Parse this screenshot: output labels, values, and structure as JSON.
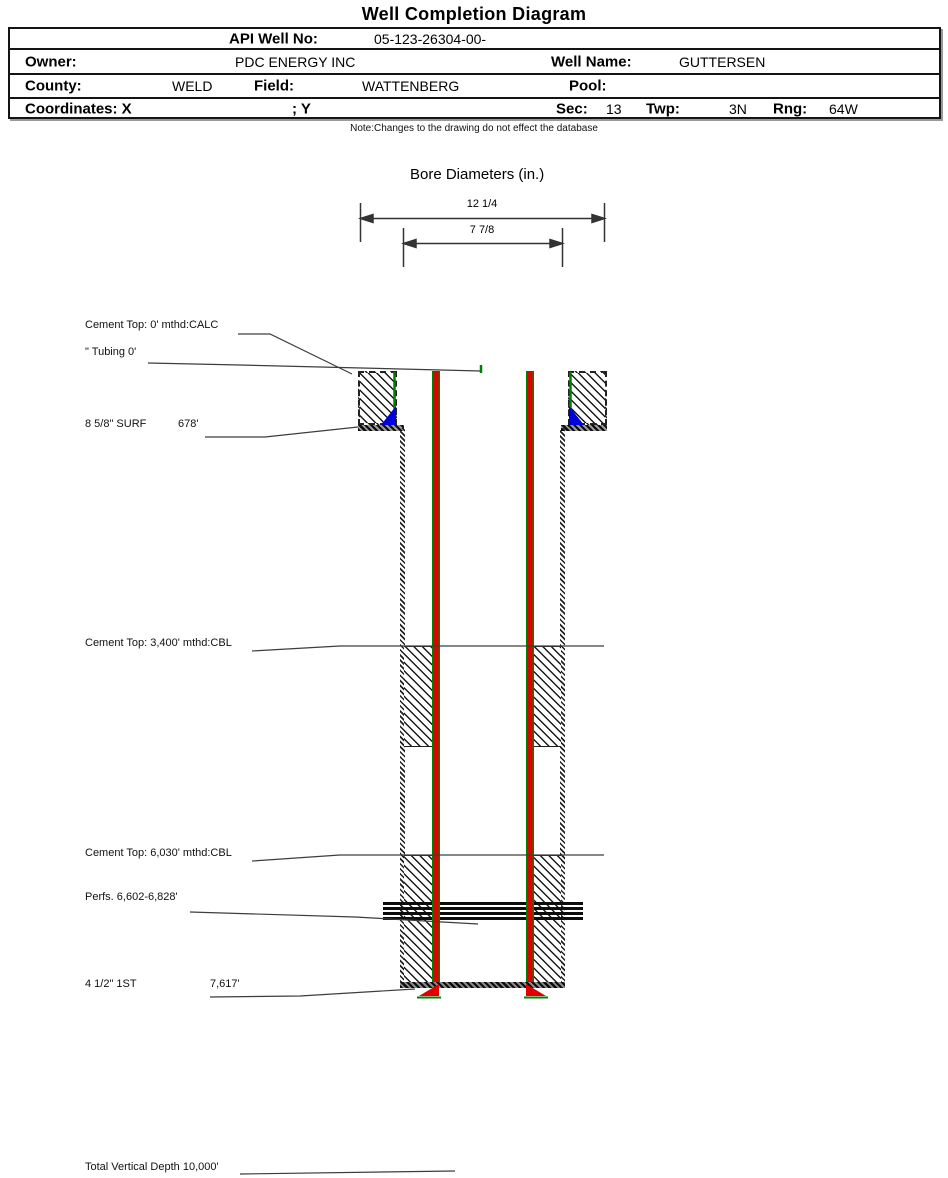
{
  "page": {
    "title": "Well Completion Diagram",
    "note": "Note:Changes to the drawing do not effect the database"
  },
  "info_table": {
    "api": {
      "label": "API Well No:",
      "value": "05-123-26304-00-"
    },
    "owner": {
      "label": "Owner:",
      "value": "PDC ENERGY INC"
    },
    "well_name": {
      "label": "Well Name:",
      "value": "GUTTERSEN"
    },
    "county": {
      "label": "County:",
      "value": "WELD"
    },
    "field": {
      "label": "Field:",
      "value": "WATTENBERG"
    },
    "pool": {
      "label": "Pool:",
      "value": ""
    },
    "coordinates": {
      "label": "Coordinates: X",
      "y_label": "; Y"
    },
    "sec": {
      "label": "Sec:",
      "value": "13"
    },
    "twp": {
      "label": "Twp:",
      "value": "3N"
    },
    "rng": {
      "label": "Rng:",
      "value": "64W"
    }
  },
  "bore_diameters": {
    "title": "Bore Diameters (in.)",
    "outer_diameter": "12 1/4",
    "inner_diameter": "7 7/8"
  },
  "annotations": {
    "cement_top_surface": "Cement Top: 0' mthd:CALC",
    "tubing": "\" Tubing 0'",
    "surface_casing_label": "8 5/8\" SURF",
    "surface_casing_depth": "678'",
    "cement_top_3400": "Cement Top: 3,400' mthd:CBL",
    "cement_top_6030": "Cement Top: 6,030' mthd:CBL",
    "perforations": "Perfs. 6,602-6,828'",
    "production_casing_label": "4 1/2\" 1ST",
    "production_casing_depth": "7,617'",
    "total_vertical_depth": "Total Vertical Depth 10,000'"
  },
  "colors": {
    "casing_red": "#e00000",
    "tubing_green": "#008000",
    "cement_shoe_blue": "#0000dd",
    "hatch_black": "#1a1a1a"
  }
}
